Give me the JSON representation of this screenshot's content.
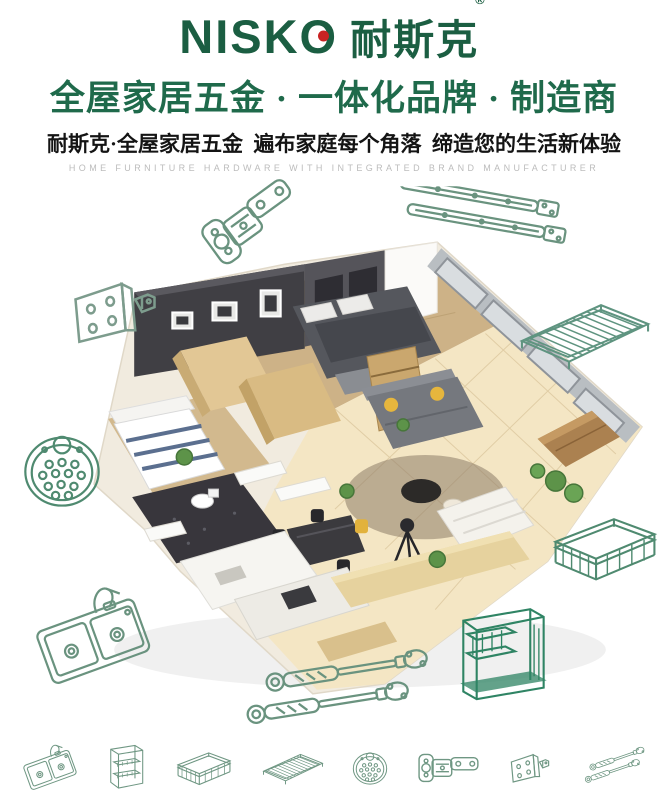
{
  "brand": {
    "logo_latin": "NISKO",
    "logo_cn": "耐斯克",
    "registered_mark": "®",
    "logo_color": "#1b5e42",
    "logo_dot_color": "#c92323"
  },
  "header": {
    "headline": "全屋家居五金 · 一体化品牌 · 制造商",
    "subheadline": "耐斯克·全屋家居五金  遍布家庭每个角落  缔造您的生活新体验",
    "tagline_en": "HOME FURNITURE HARDWARE WITH INTEGRATED BRAND MANUFACTURER",
    "headline_color": "#1f6a4b",
    "subheadline_color": "#141414",
    "tagline_color": "#bcbcbc"
  },
  "hero": {
    "type": "isometric-3d-apartment-render",
    "sketch_line_color": "#6a937f"
  },
  "floating_sketches": [
    {
      "id": "cabinet-hinge"
    },
    {
      "id": "ball-bearing-drawer-slides"
    },
    {
      "id": "hinge-mounting-bracket"
    },
    {
      "id": "perforated-round-plate"
    },
    {
      "id": "double-bowl-kitchen-sink"
    },
    {
      "id": "wire-shelf-rack"
    },
    {
      "id": "wire-drawer-basket"
    },
    {
      "id": "kitchen-storage-rack"
    },
    {
      "id": "gas-lift-struts"
    }
  ],
  "footer_sketches": [
    {
      "id": "double-bowl-kitchen-sink"
    },
    {
      "id": "pull-out-cabinet-basket"
    },
    {
      "id": "wire-drawer-basket"
    },
    {
      "id": "wire-shelf-rack"
    },
    {
      "id": "perforated-round-plate"
    },
    {
      "id": "cabinet-hinge"
    },
    {
      "id": "hinge-mounting-bracket"
    },
    {
      "id": "gas-lift-struts"
    }
  ]
}
